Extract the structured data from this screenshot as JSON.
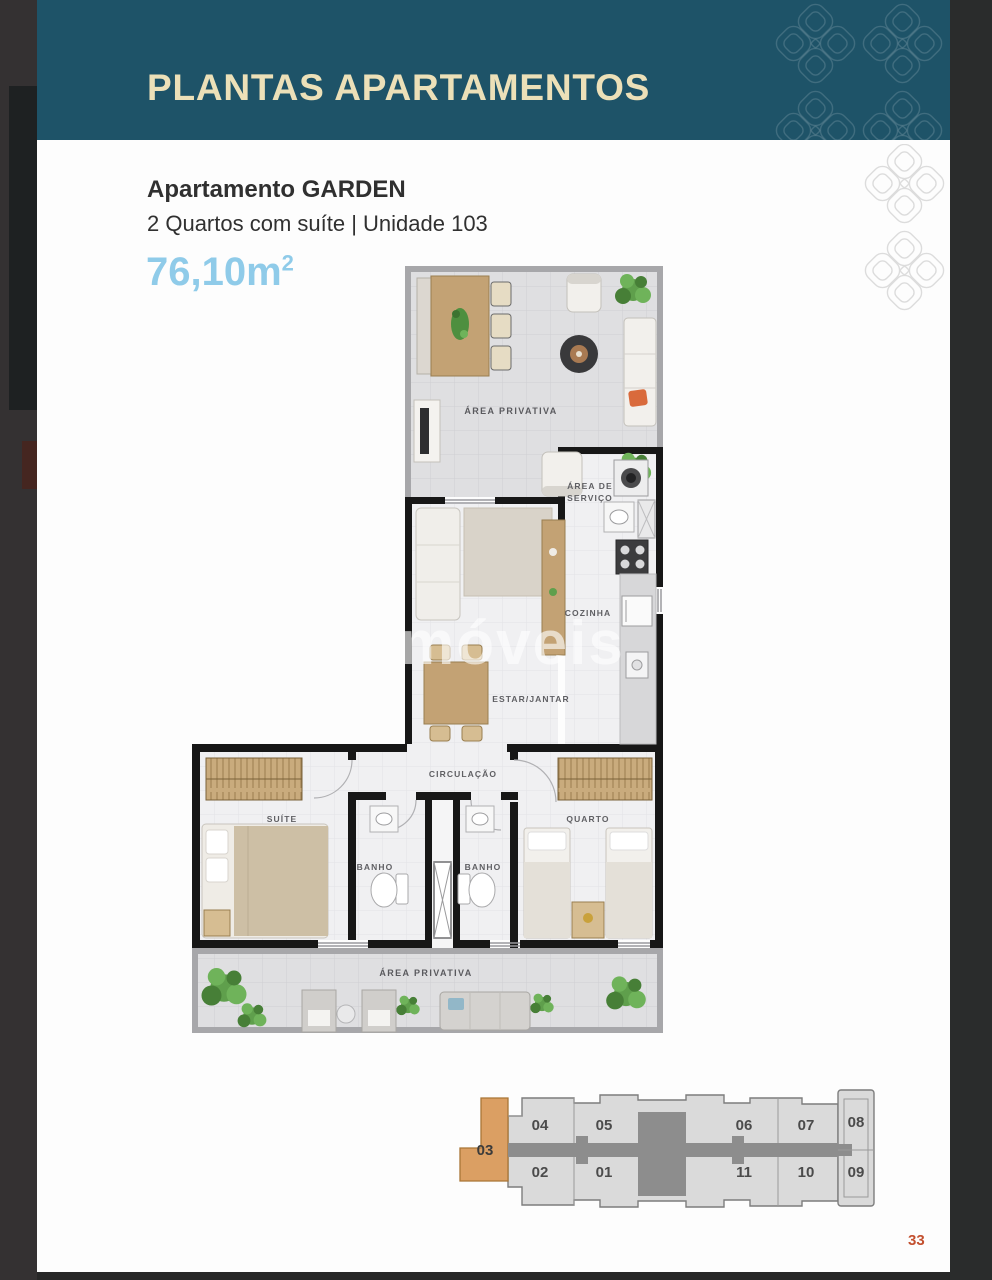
{
  "page": {
    "header": {
      "title": "PLANTAS APARTAMENTOS"
    },
    "apartment": {
      "title": "Apartamento GARDEN",
      "subtitle": "2 Quartos com suíte | Unidade 103",
      "area_value": "76,10m",
      "area_sup": "2"
    },
    "floor_plan": {
      "watermark": "móveis",
      "rooms": {
        "area_privativa_top": "ÁREA PRIVATIVA",
        "area_servico_line1": "ÁREA DE",
        "area_servico_line2": "SERVIÇO",
        "cozinha": "COZINHA",
        "estar_jantar": "ESTAR/JANTAR",
        "circulacao": "CIRCULAÇÃO",
        "suite": "SUÍTE",
        "banho_1": "BANHO",
        "banho_2": "BANHO",
        "quarto": "QUARTO",
        "area_privativa_bottom": "ÁREA PRIVATIVA"
      }
    },
    "key_plan": {
      "highlighted_unit": "03",
      "top_row": [
        "04",
        "05",
        "06",
        "07",
        "08"
      ],
      "bottom_row": [
        "02",
        "01",
        "11",
        "10",
        "09"
      ]
    },
    "page_number": "33",
    "colors": {
      "header_bg": "#1e5368",
      "header_text": "#ece0b8",
      "area_text": "#8fcbe9",
      "page_number": "#c3502f",
      "keyplan_highlight": "#db9f63",
      "keyplan_corridor": "#8d8d8d"
    }
  }
}
